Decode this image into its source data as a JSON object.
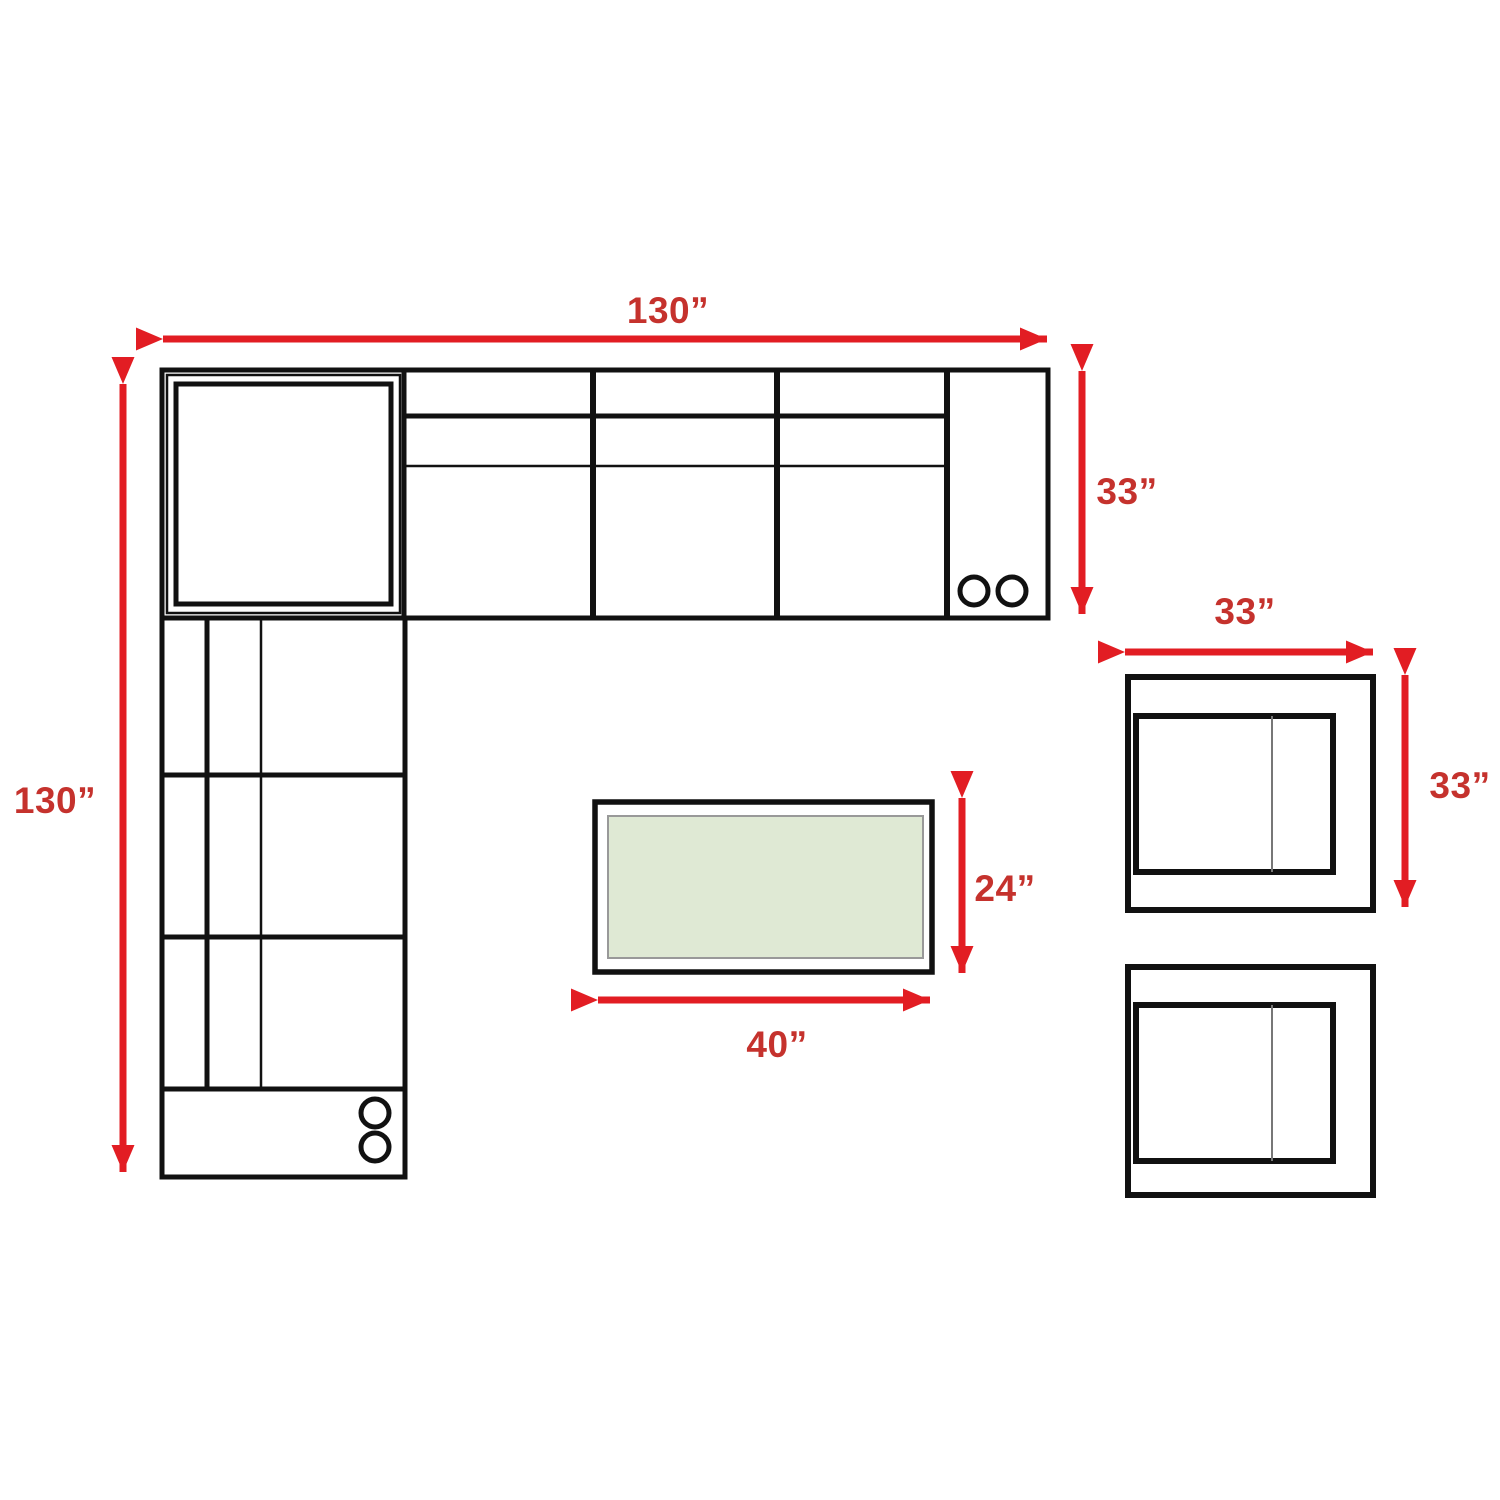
{
  "diagram": {
    "type": "furniture-dimension-floor-plan",
    "background_color": "#ffffff",
    "outline_color": "#111111",
    "arrow_color": "#e21d23",
    "label_color": "#c5322d",
    "table_fill_color": "#dfe9d4",
    "table_inner_stroke_color": "#999999",
    "pieces": [
      "sectional-sofa-horizontal-wing",
      "sectional-sofa-vertical-wing",
      "corner-wedge",
      "coffee-table",
      "armchair-top",
      "armchair-bottom"
    ],
    "labels": {
      "sectional_width": "130”",
      "sectional_depth": "130”",
      "sofa_seat_depth": "33”",
      "armchair_width": "33”",
      "armchair_depth": "33”",
      "table_depth": "24”",
      "table_width": "40”"
    }
  }
}
